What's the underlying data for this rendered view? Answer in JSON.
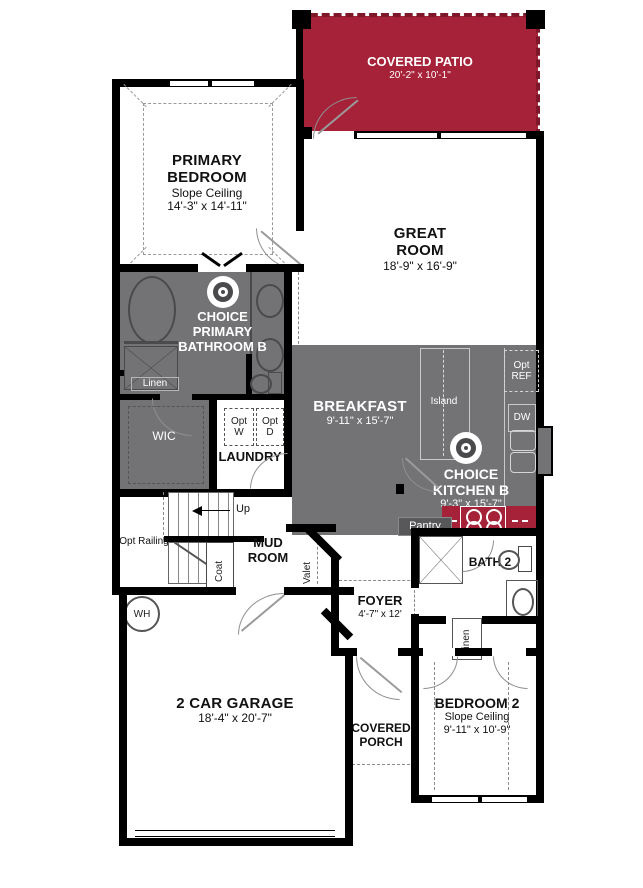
{
  "colors": {
    "patio_red": "#A52238",
    "range_red": "#A52238",
    "room_gray": "#737376",
    "wall": "#000000",
    "text_light": "#FFFFFF",
    "text_dark": "#111111"
  },
  "rooms": {
    "covered_patio": {
      "name": "COVERED PATIO",
      "dims": "20'-2\" x 10'-1\""
    },
    "primary_bedroom": {
      "name": "PRIMARY BEDROOM",
      "ceiling": "Slope Ceiling",
      "dims": "14'-3\" x 14'-11\""
    },
    "great_room": {
      "name": "GREAT ROOM",
      "dims": "18'-9\" x 16'-9\""
    },
    "primary_bathroom": {
      "name": "CHOICE PRIMARY BATHROOM B"
    },
    "linen_bathroom": {
      "name": "Linen"
    },
    "wic": {
      "name": "WIC"
    },
    "laundry": {
      "name": "LAUNDRY",
      "opt_washer": "Opt W",
      "opt_dryer": "Opt D"
    },
    "breakfast": {
      "name": "BREAKFAST",
      "dims": "9'-11\" x 15'-7\""
    },
    "kitchen": {
      "name": "CHOICE KITCHEN B",
      "dims": "9'-3\" x 15'-7\"",
      "island": "Island",
      "opt_fridge": "Opt REF",
      "dishwasher": "DW",
      "pantry": "Pantry"
    },
    "mud_room": {
      "name": "MUD ROOM",
      "coat": "Coat",
      "valet": "Valet"
    },
    "stairs": {
      "direction": "Up",
      "opt_railing": "Opt Railing"
    },
    "utility": {
      "water_heater": "WH"
    },
    "foyer": {
      "name": "FOYER",
      "dims": "4'-7\" x 12'"
    },
    "bath2": {
      "name": "BATH 2"
    },
    "linen_hall": {
      "name": "Linen"
    },
    "bedroom2": {
      "name": "BEDROOM 2",
      "ceiling": "Slope Ceiling",
      "dims": "9'-11\" x 10'-9\""
    },
    "covered_porch": {
      "name": "COVERED PORCH"
    },
    "garage": {
      "name": "2 CAR GARAGE",
      "dims": "18'-4\" x 20'-7\""
    }
  }
}
